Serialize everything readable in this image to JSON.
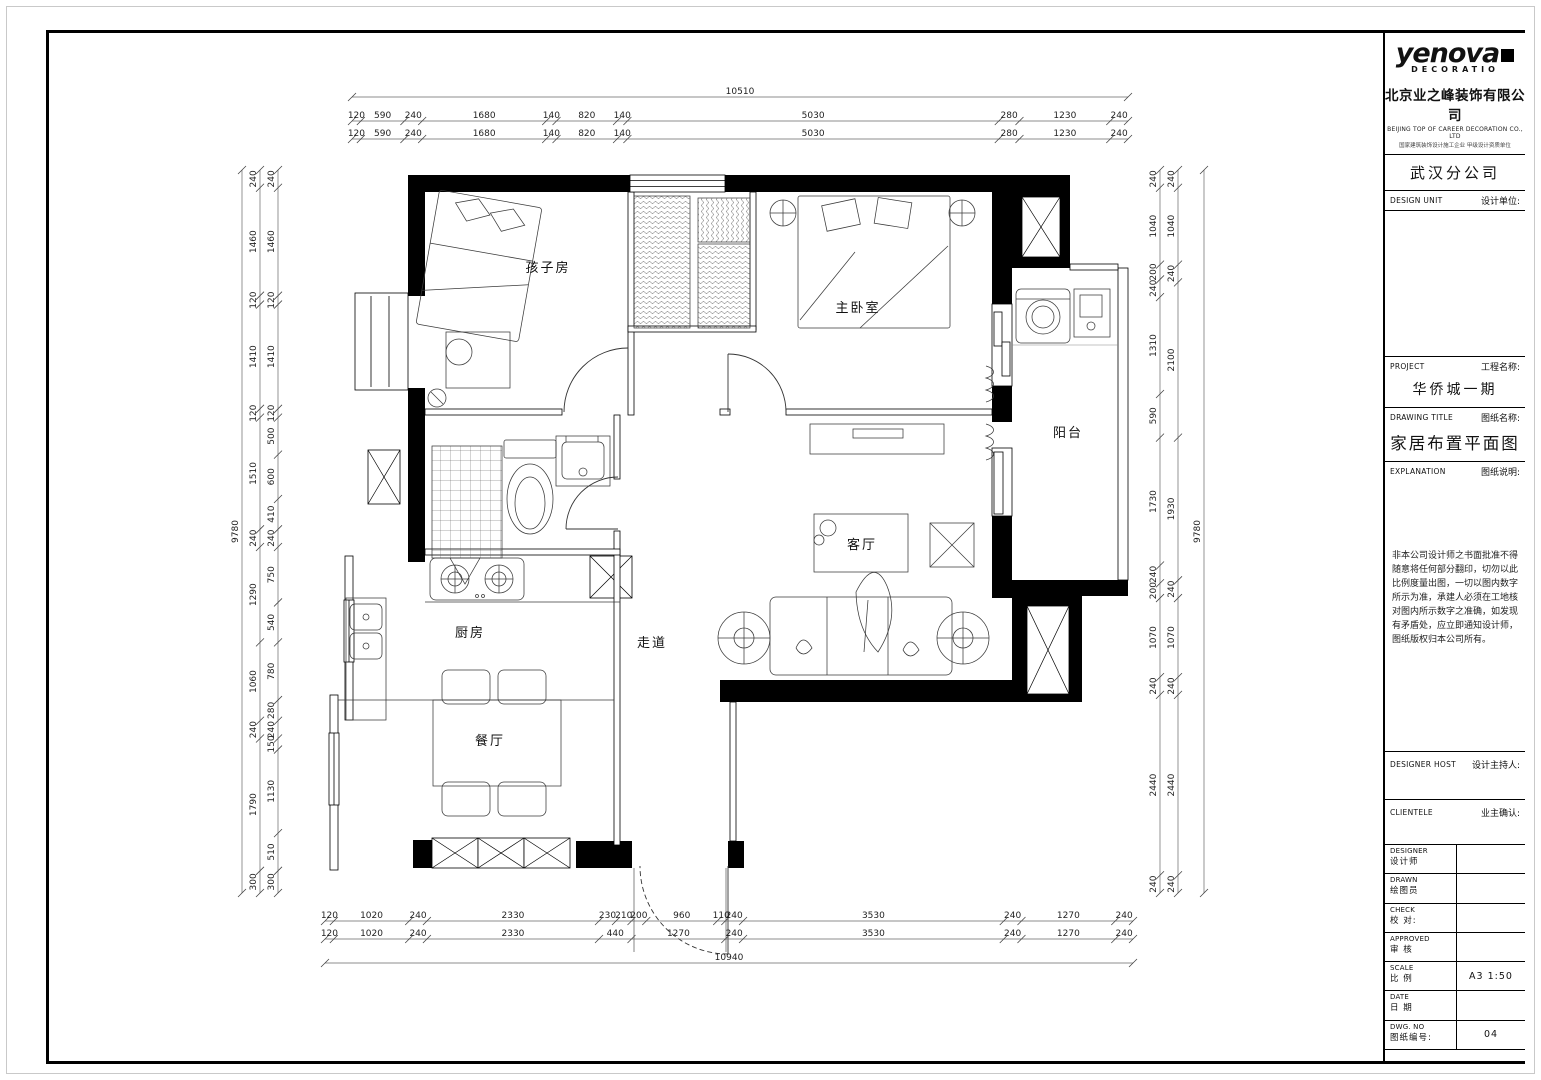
{
  "title_block": {
    "logo_text": "yenova",
    "logo_sub": "DECORATIO",
    "company_cn": "北京业之峰装饰有限公司",
    "company_en": "BEIJING TOP OF CAREER DECORATION CO., LTD",
    "company_tagline": "国家建筑装饰设计施工企业 甲级设计资质单位",
    "branch": "武汉分公司",
    "design_unit_en": "DESIGN UNIT",
    "design_unit_cn": "设计单位:",
    "project_en": "PROJECT",
    "project_cn": "工程名称:",
    "project_value": "华侨城一期",
    "drawing_title_en": "DRAWING TITLE",
    "drawing_title_cn": "图纸名称:",
    "drawing_title_value": "家居布置平面图",
    "explanation_en": "EXPLANATION",
    "explanation_cn": "图纸说明:",
    "explanation_text": "非本公司设计师之书面批准不得随意将任何部分翻印，切勿以此比例度量出图，一切以图内数字所示为准，承建人必须在工地核对图内所示数字之准确，如发现有矛盾处，应立即通知设计师，图纸版权归本公司所有。",
    "designer_host_en": "DESIGNER HOST",
    "designer_host_cn": "设计主持人:",
    "clientele_en": "CLIENTELE",
    "clientele_cn": "业主确认:",
    "rows": [
      {
        "en": "DESIGNER",
        "cn": "设计师",
        "value": ""
      },
      {
        "en": "DRAWN",
        "cn": "绘图员",
        "value": ""
      },
      {
        "en": "CHECK",
        "cn": "校 对:",
        "value": ""
      },
      {
        "en": "APPROVED",
        "cn": "审 核",
        "value": ""
      },
      {
        "en": "SCALE",
        "cn": "比 例",
        "value": "A3  1:50"
      },
      {
        "en": "DATE",
        "cn": "日 期",
        "value": ""
      },
      {
        "en": "DWG. NO",
        "cn": "图纸编号:",
        "value": "04"
      }
    ]
  },
  "rooms": {
    "children_room": "孩子房",
    "master_bedroom": "主卧室",
    "balcony": "阳台",
    "living_room": "客厅",
    "corridor": "走道",
    "kitchen": "厨房",
    "dining_room": "餐厅"
  },
  "dimensions": {
    "top": {
      "overall": 10510,
      "row1": [
        120,
        590,
        240,
        1680,
        140,
        820,
        140,
        5030,
        280,
        1230,
        240
      ],
      "row2": [
        120,
        590,
        240,
        1680,
        140,
        820,
        140,
        5030,
        280,
        1230,
        240
      ]
    },
    "bottom": {
      "overall": 10940,
      "row1": [
        120,
        1020,
        240,
        2330,
        230,
        210,
        200,
        960,
        110,
        240,
        3530,
        240,
        1270,
        240
      ],
      "row2": [
        120,
        1020,
        240,
        2330,
        440,
        1270,
        240,
        3530,
        240,
        1270,
        240
      ]
    },
    "left": {
      "overall": 9780,
      "outer": [
        240,
        1460,
        120,
        1410,
        120,
        1510,
        240,
        1290,
        1060,
        240,
        1790,
        300
      ],
      "inner": [
        240,
        1460,
        120,
        1410,
        120,
        500,
        600,
        410,
        240,
        750,
        540,
        780,
        280,
        240,
        150,
        1130,
        510,
        300
      ]
    },
    "right": {
      "overall": 9780,
      "inner": [
        240,
        1040,
        200,
        240,
        1310,
        590,
        1730,
        240,
        200,
        1070,
        240,
        2440,
        240
      ],
      "outer": [
        240,
        1040,
        240,
        2100,
        1930,
        240,
        1070,
        240,
        2440,
        240
      ]
    }
  },
  "colors": {
    "line": "#000000",
    "paper": "#ffffff"
  }
}
